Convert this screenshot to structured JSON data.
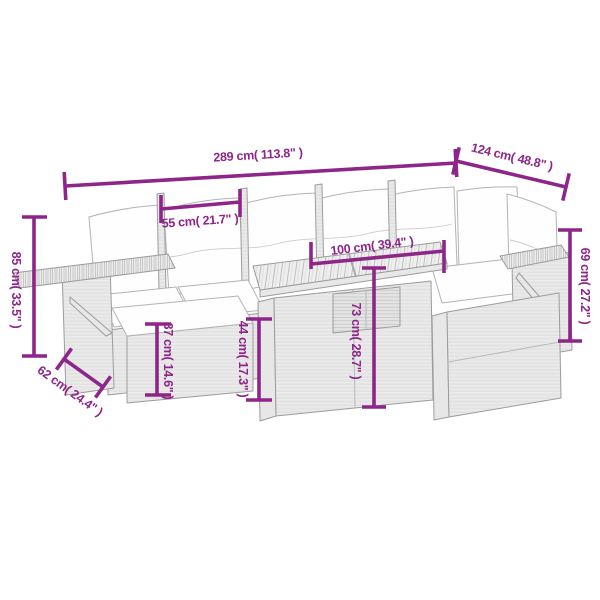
{
  "page": {
    "background_color": "#ffffff",
    "description": "Dimension diagram line drawing of a rattan garden lounge sofa set with cushions, ottoman and storage table"
  },
  "diagram": {
    "accent_color": "#8e2589",
    "sketch_line_color": "#9c9c9c",
    "cushion_color": "#fefefe",
    "dimensions": {
      "total_width": {
        "cm": 289,
        "inches": 113.8,
        "label": "289 cm( 113.8\" )"
      },
      "right_depth": {
        "cm": 124,
        "inches": 48.8,
        "label": "124 cm( 48.8\" )"
      },
      "back_height": {
        "cm": 85,
        "inches": 33.5,
        "label": "85 cm( 33.5\" )"
      },
      "seat_width": {
        "cm": 55,
        "inches": 21.7,
        "label": "55 cm( 21.7\" )"
      },
      "table_width": {
        "cm": 100,
        "inches": 39.4,
        "label": "100 cm( 39.4\" )"
      },
      "arm_height": {
        "cm": 69,
        "inches": 27.2,
        "label": "69 cm( 27.2\" )"
      },
      "table_height": {
        "cm": 73,
        "inches": 28.7,
        "label": "73 cm( 28.7\" )"
      },
      "seat_height": {
        "cm": 44,
        "inches": 17.3,
        "label": "44 cm( 17.3\" )"
      },
      "ottoman_height": {
        "cm": 37,
        "inches": 14.6,
        "label": "37 cm( 14.6\" )"
      },
      "ottoman_depth": {
        "cm": 62,
        "inches": 24.4,
        "label": "62 cm( 24.4\" )"
      }
    }
  }
}
